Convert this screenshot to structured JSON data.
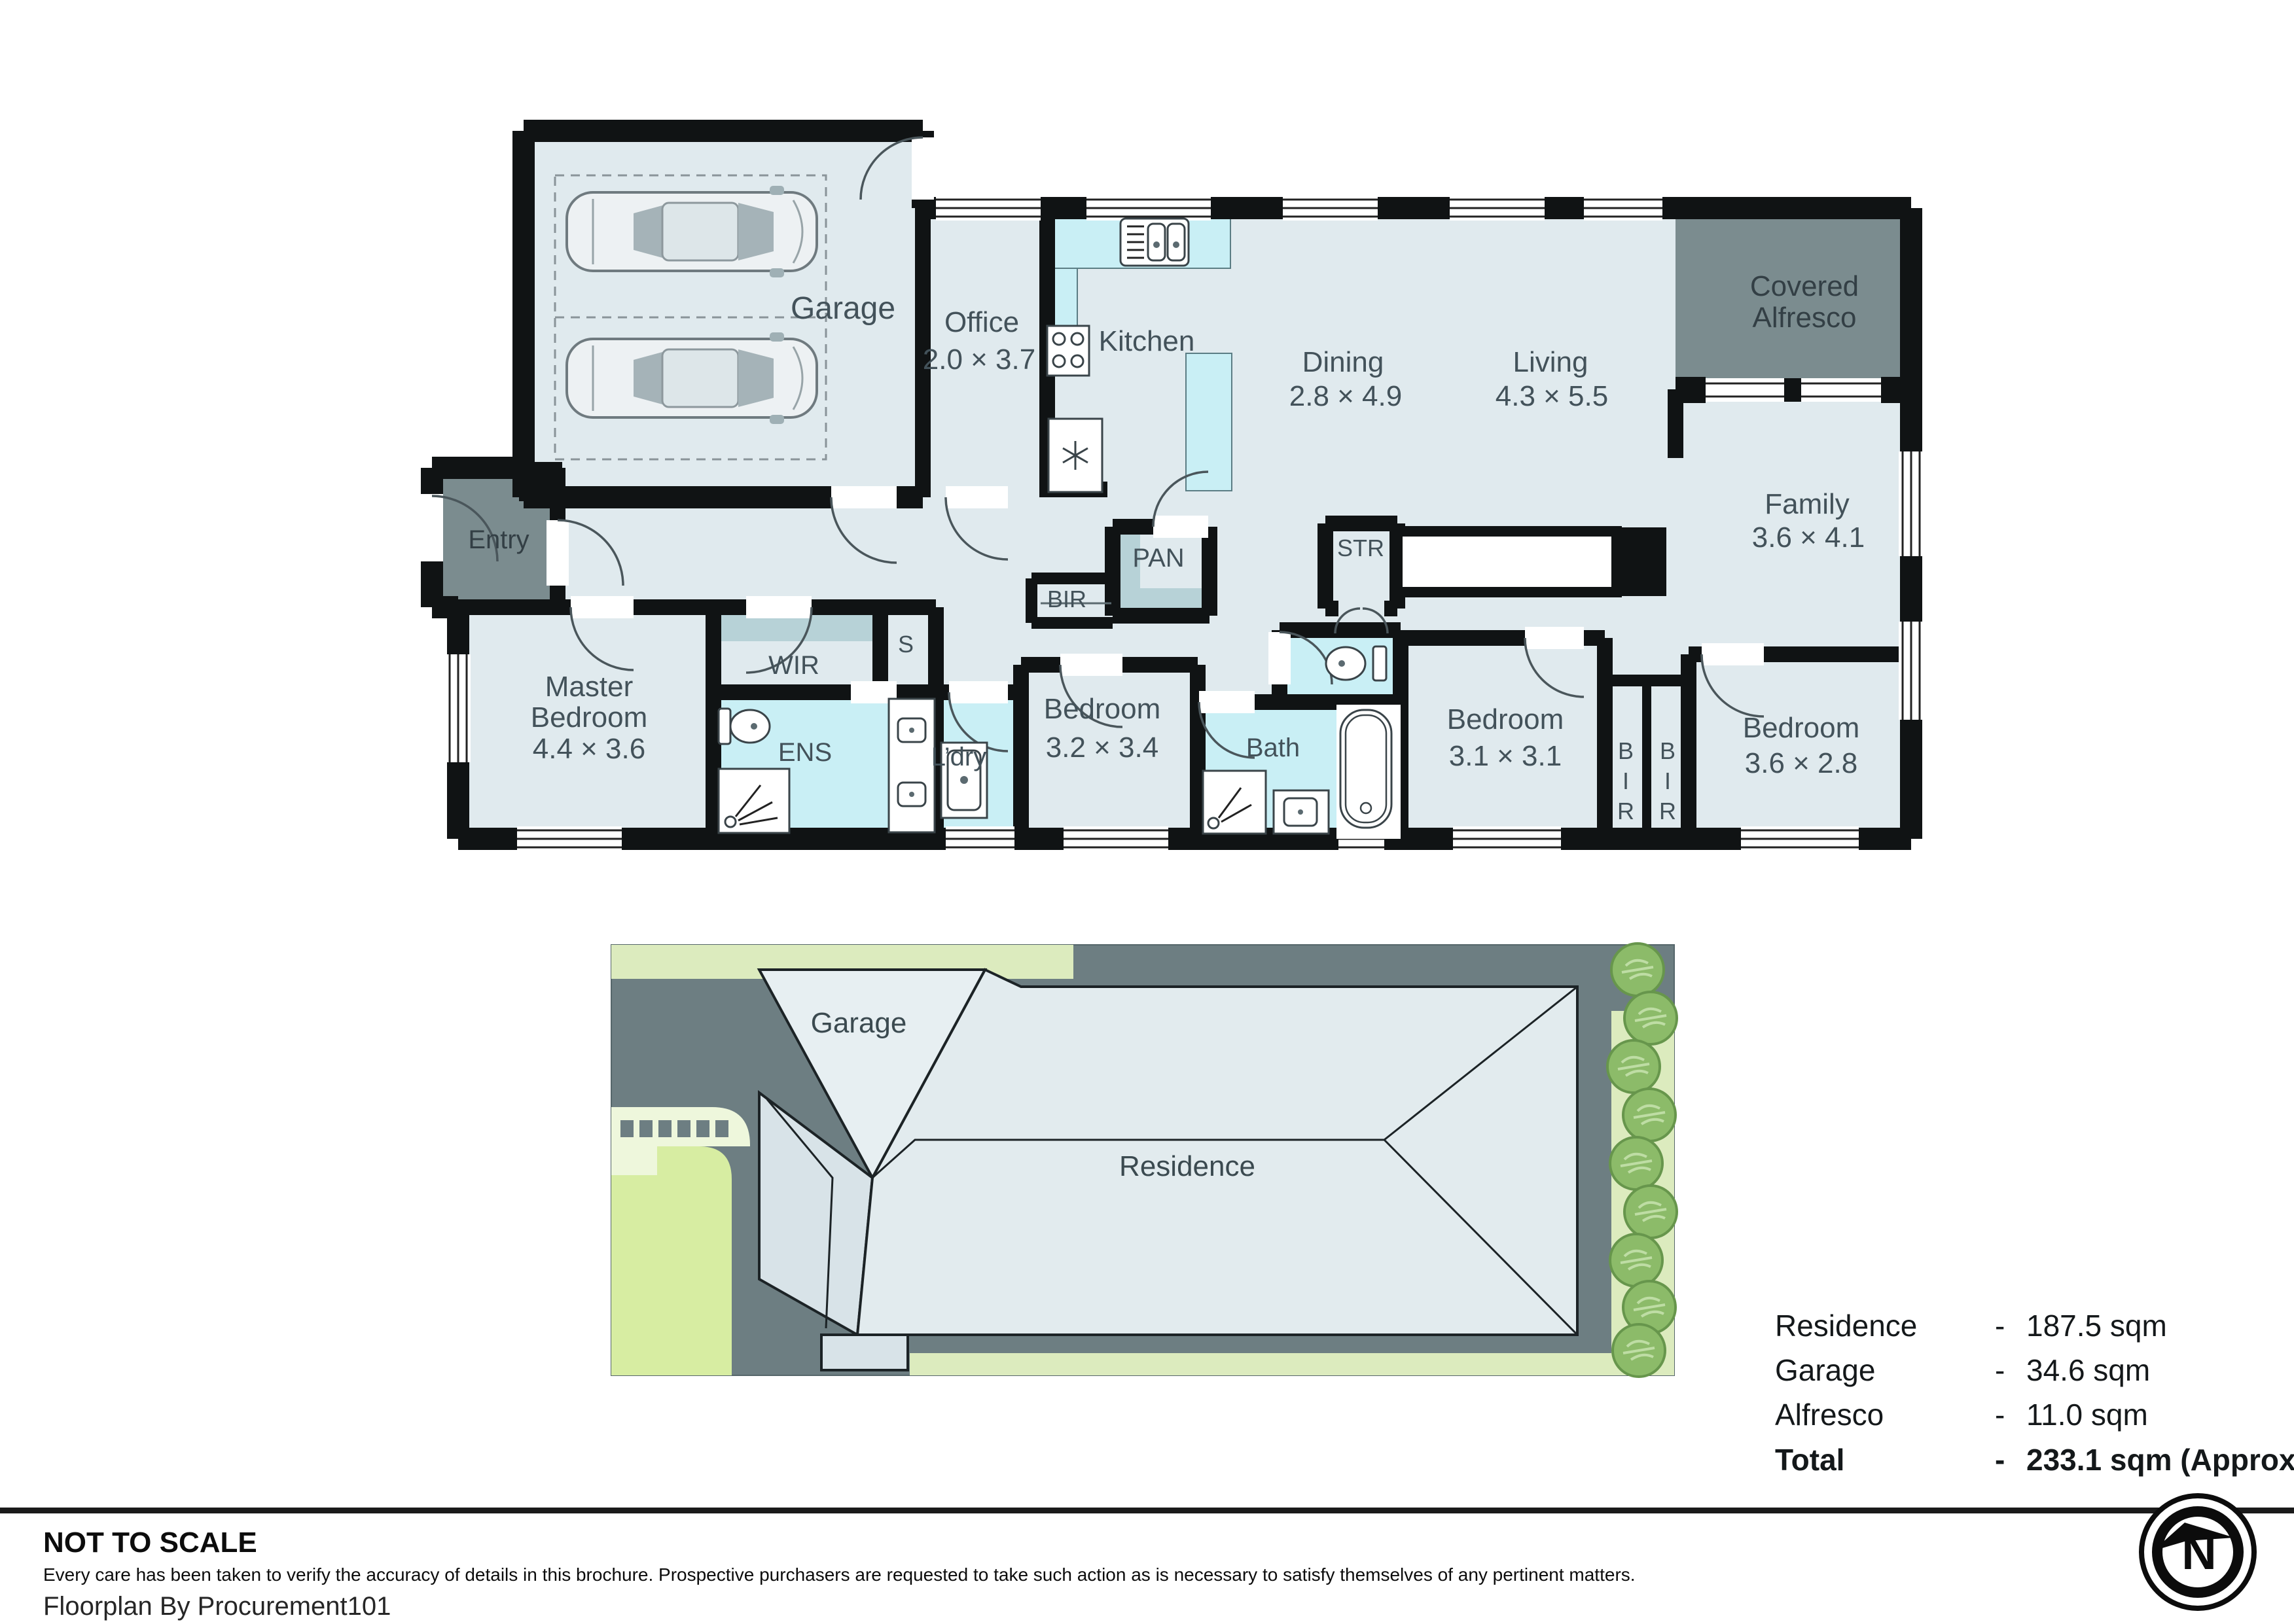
{
  "palette": {
    "floor": "#e0eaee",
    "wet": "#c9eff5",
    "closet": "#b7d2d7",
    "outdoor": "#7b8c8f",
    "wall": "#101314",
    "roomtext": "#43525a",
    "lot": "#6d7e82",
    "grass": "#d7eda2",
    "verge": "#dcebbe",
    "pale": "#eef7dc",
    "tree": "#8cbb69",
    "roof": "#e2ebee",
    "roof2": "#d8e3e8",
    "ink": "#14181a"
  },
  "floorplan": {
    "rooms": {
      "garage": {
        "name": "Garage"
      },
      "office": {
        "name": "Office",
        "dims": "2.0 × 3.7"
      },
      "kitchen": {
        "name": "Kitchen"
      },
      "dining": {
        "name": "Dining",
        "dims": "2.8 × 4.9"
      },
      "living": {
        "name": "Living",
        "dims": "4.3 × 5.5"
      },
      "alfresco": {
        "line1": "Covered",
        "line2": "Alfresco"
      },
      "entry": {
        "name": "Entry"
      },
      "family": {
        "name": "Family",
        "dims": "3.6 × 4.1"
      },
      "str": {
        "name": "STR"
      },
      "pan": {
        "name": "PAN"
      },
      "bir_hall": {
        "name": "BIR"
      },
      "master": {
        "line1": "Master",
        "line2": "Bedroom",
        "dims": "4.4 × 3.6"
      },
      "wir": {
        "name": "WIR"
      },
      "s": {
        "name": "S"
      },
      "ens": {
        "name": "ENS"
      },
      "ldry": {
        "name": "L’dry"
      },
      "bed2": {
        "name": "Bedroom",
        "dims": "3.2 × 3.4"
      },
      "bath": {
        "name": "Bath"
      },
      "bed3": {
        "name": "Bedroom",
        "dims": "3.1 × 3.1"
      },
      "bir_left": {
        "letters": [
          "B",
          "I",
          "R"
        ]
      },
      "bir_right": {
        "letters": [
          "B",
          "I",
          "R"
        ]
      },
      "bed4": {
        "name": "Bedroom",
        "dims": "3.6 × 2.8"
      }
    }
  },
  "siteplan": {
    "garage_label": "Garage",
    "residence_label": "Residence"
  },
  "summary": {
    "rows": [
      {
        "label": "Residence",
        "dash": "-",
        "value": "187.5 sqm"
      },
      {
        "label": "Garage",
        "dash": "-",
        "value": "34.6 sqm"
      },
      {
        "label": "Alfresco",
        "dash": "-",
        "value": "11.0 sqm"
      },
      {
        "label": "Total",
        "dash": "-",
        "value": "233.1 sqm (Approx)"
      }
    ]
  },
  "footer": {
    "scale_note": "NOT TO SCALE",
    "disclaimer": "Every care has been taken to verify the accuracy of details in this brochure. Prospective purchasers are requested to take such action as is necessary to satisfy themselves of any pertinent matters.",
    "credit": "Floorplan By Procurement101",
    "compass_n": "N"
  }
}
